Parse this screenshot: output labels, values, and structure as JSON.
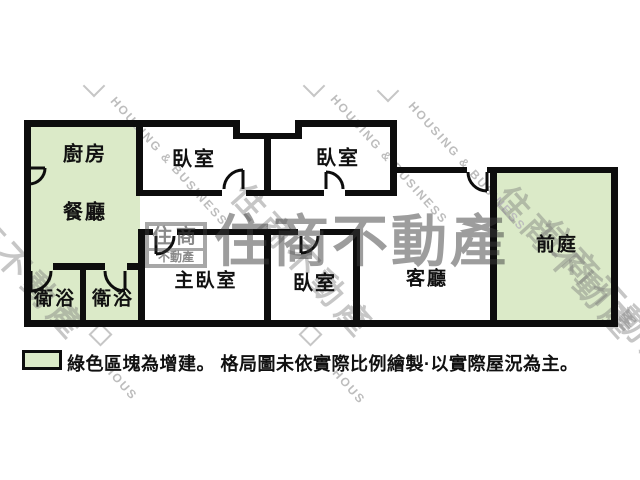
{
  "colors": {
    "wall": "#0d0d0d",
    "green": "#dbeac8",
    "watermark_gray": "#bdbdbd"
  },
  "plan": {
    "rooms": [
      {
        "id": "kitchen",
        "label": "廚房"
      },
      {
        "id": "dining",
        "label": "餐廳"
      },
      {
        "id": "bedroom1",
        "label": "臥室"
      },
      {
        "id": "bedroom2",
        "label": "臥室"
      },
      {
        "id": "bath1",
        "label": "衛浴"
      },
      {
        "id": "bath2",
        "label": "衛浴"
      },
      {
        "id": "master-bedroom",
        "label": "主臥室"
      },
      {
        "id": "bedroom3",
        "label": "臥室"
      },
      {
        "id": "living-room",
        "label": "客廳"
      },
      {
        "id": "front-yard",
        "label": "前庭"
      }
    ]
  },
  "legend": {
    "text": "綠色區塊為增建。 格局圖未依實際比例繪製·以實際屋況為主。"
  },
  "watermark": {
    "brand": "住商不動產",
    "brand_en": "HOUSING & BUSINESS",
    "brand_en_partial": "HOUS",
    "logo_top": "住商",
    "logo_bottom": "不動產"
  }
}
